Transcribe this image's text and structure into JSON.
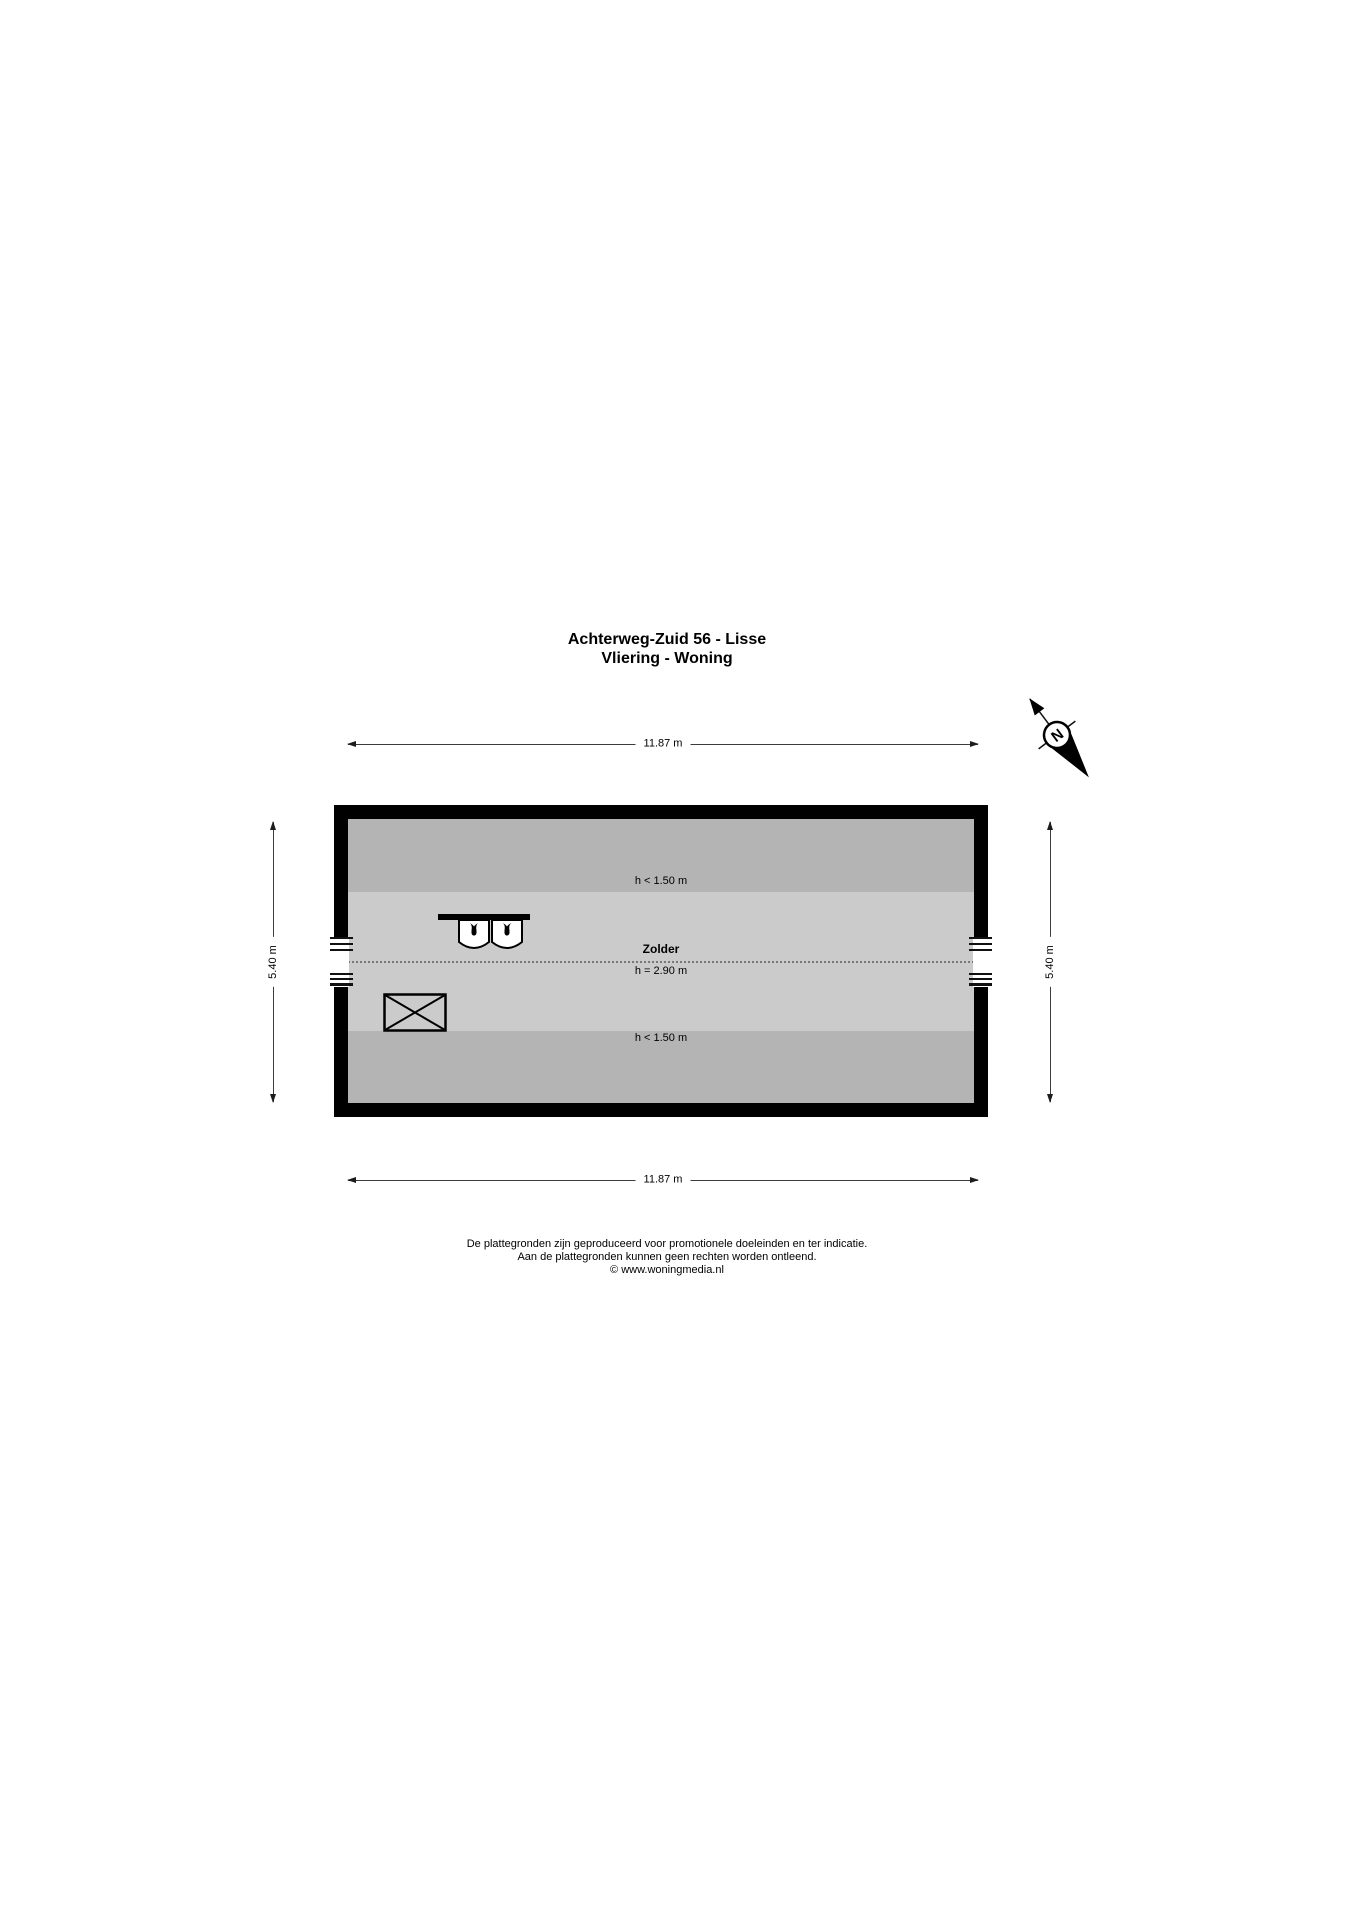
{
  "title": {
    "line1": "Achterweg-Zuid 56 - Lisse",
    "line2": "Vliering - Woning"
  },
  "compass": {
    "north": "N"
  },
  "plan": {
    "labels": {
      "low_top": "h < 1.50 m",
      "room": "Zolder",
      "room_height": "h = 2.90 m",
      "low_bottom": "h < 1.50 m"
    },
    "dimensions": {
      "top": "11.87 m",
      "bottom": "11.87 m",
      "left": "5.40 m",
      "right": "5.40 m"
    },
    "colors": {
      "wall": "#000000",
      "floor": "#cbcbcb",
      "low_ceiling_zone": "#b4b4b4",
      "dotted_ridge_line": "#787878",
      "background": "#ffffff"
    }
  },
  "footer": {
    "line1": "De plattegronden zijn geproduceerd voor promotionele doeleinden en ter indicatie.",
    "line2": "Aan de plattegronden kunnen geen rechten worden ontleend.",
    "line3": "© www.woningmedia.nl"
  }
}
